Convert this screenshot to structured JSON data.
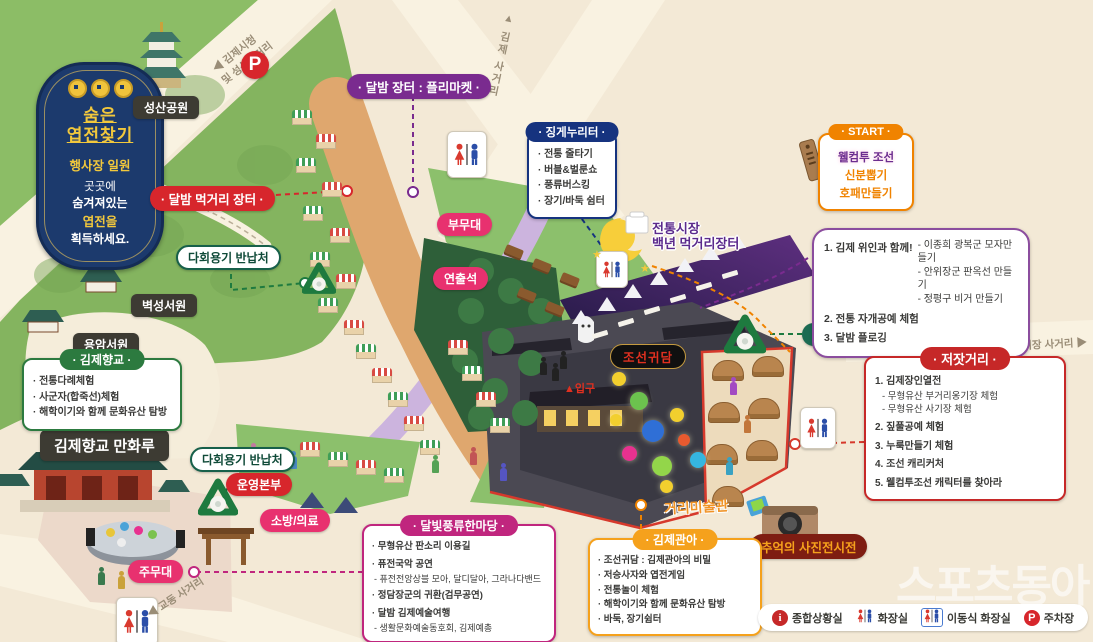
{
  "badge": {
    "line1": "숨은",
    "line2": "엽전찾기",
    "line3": "행사장 일원",
    "line4": "곳곳에",
    "line5": "숨겨져있는",
    "line6": "엽전을",
    "line7": "획득하세요."
  },
  "roads": {
    "city_hall_1": "◀ 김제시청",
    "city_hall_2": "및 성산사거리",
    "gimje": "▲ 김제 사거리",
    "market": "전통시장 사거리 ▶",
    "gyodong": "◀ 교동 사거리"
  },
  "labels": {
    "seongsan_park": "성산공원",
    "flea_market": "· 달밤 장터 : 플리마켓 ·",
    "food_market": "· 달밤 먹거리 장터 ·",
    "reuse_return": "다회용기 반납처",
    "sub_stage": "부무대",
    "producer_seat": "연출석",
    "byeokseong_seowon": "벽성서원",
    "yongam_seowon": "용암서원",
    "hyanggyo_manhwaru": "김제향교 만화루",
    "ops_hq": "운영본부",
    "fire_medical": "소방/의료",
    "main_stage": "주무대",
    "night_market_1": "전통시장",
    "night_market_2": "백년 먹거리장터",
    "joseon_gwidam": "조선귀담",
    "entrance": "▲입구",
    "street_gallery": "거리미술관",
    "photo_exhibition": "추억의 사진전시전",
    "parking_p": "P"
  },
  "boxes": {
    "jingge": {
      "title": "· 징게누리터 ·",
      "items": [
        "· 전통 줄타기",
        "· 버블&벌룬쇼",
        "· 풍류버스킹",
        "· 장기/바둑 쉼터"
      ]
    },
    "start": {
      "title": "· START ·",
      "lines": [
        "웰컴투 조선",
        "신분뽑기",
        "호패만들기"
      ]
    },
    "program": {
      "item1_title": "1. 김제 위인과 함께!",
      "item1_subs": [
        "- 이종희 광복군 모자만들기",
        "- 안위장군 판옥선 만들기",
        "- 정평구 비거 만들기"
      ],
      "item2": "2. 전통 자개공예 체험",
      "item3": "3. 달밤 플로깅"
    },
    "hyanggyo": {
      "title": "· 김제향교 ·",
      "items": [
        "· 전통다례체험",
        "· 사군자(합죽선)체험",
        "· 해학이기와 함께 문화유산 탐방"
      ]
    },
    "jeotgat": {
      "title": "· 저잣거리 ·",
      "items": [
        "1. 김제장인열전",
        "- 무형유산 부거리옹기장 체험",
        "- 무형유산 사기장 체험",
        "2. 짚풀공예 체험",
        "3. 누룩만들기 체험",
        "4. 조선 캐리커처",
        "5. 웰컴투조선 캐릭터를 찾아라"
      ]
    },
    "moonlight": {
      "title": "· 달빛풍류한마당 ·",
      "items": [
        "· 무형유산 판소리 이용길",
        "· 퓨전국악 공연",
        "- 퓨전전앙상블 모아, 달디달아, 그라나다밴드",
        "· 정담장군의 귀환(검무공연)",
        "· 달밤 김제예술여행",
        "- 생활문화예술동호회, 김제예총"
      ]
    },
    "gwana": {
      "title": "· 김제관아 ·",
      "items": [
        "· 조선귀담 : 김제관아의 비밀",
        "· 저승사자와 엽전게임",
        "· 전통놀이 체험",
        "· 해학이기와 함께 문화유산 탐방",
        "· 바둑, 장기쉼터"
      ]
    }
  },
  "legend": {
    "info": "종합상황실",
    "toilet": "화장실",
    "portable_toilet": "이동식 화장실",
    "parking": "주차장",
    "parking_p": "P",
    "info_i": "i"
  },
  "watermark": "스포츠동아",
  "colors": {
    "red": "#d7262c",
    "purple": "#7a2b8f",
    "navy": "#16337f",
    "green": "#1e7a3f",
    "orange": "#f08300",
    "magenta": "#c0267e",
    "pink": "#e8316f",
    "badge_navy": "#1c3a6d",
    "gold": "#f2c83c"
  }
}
